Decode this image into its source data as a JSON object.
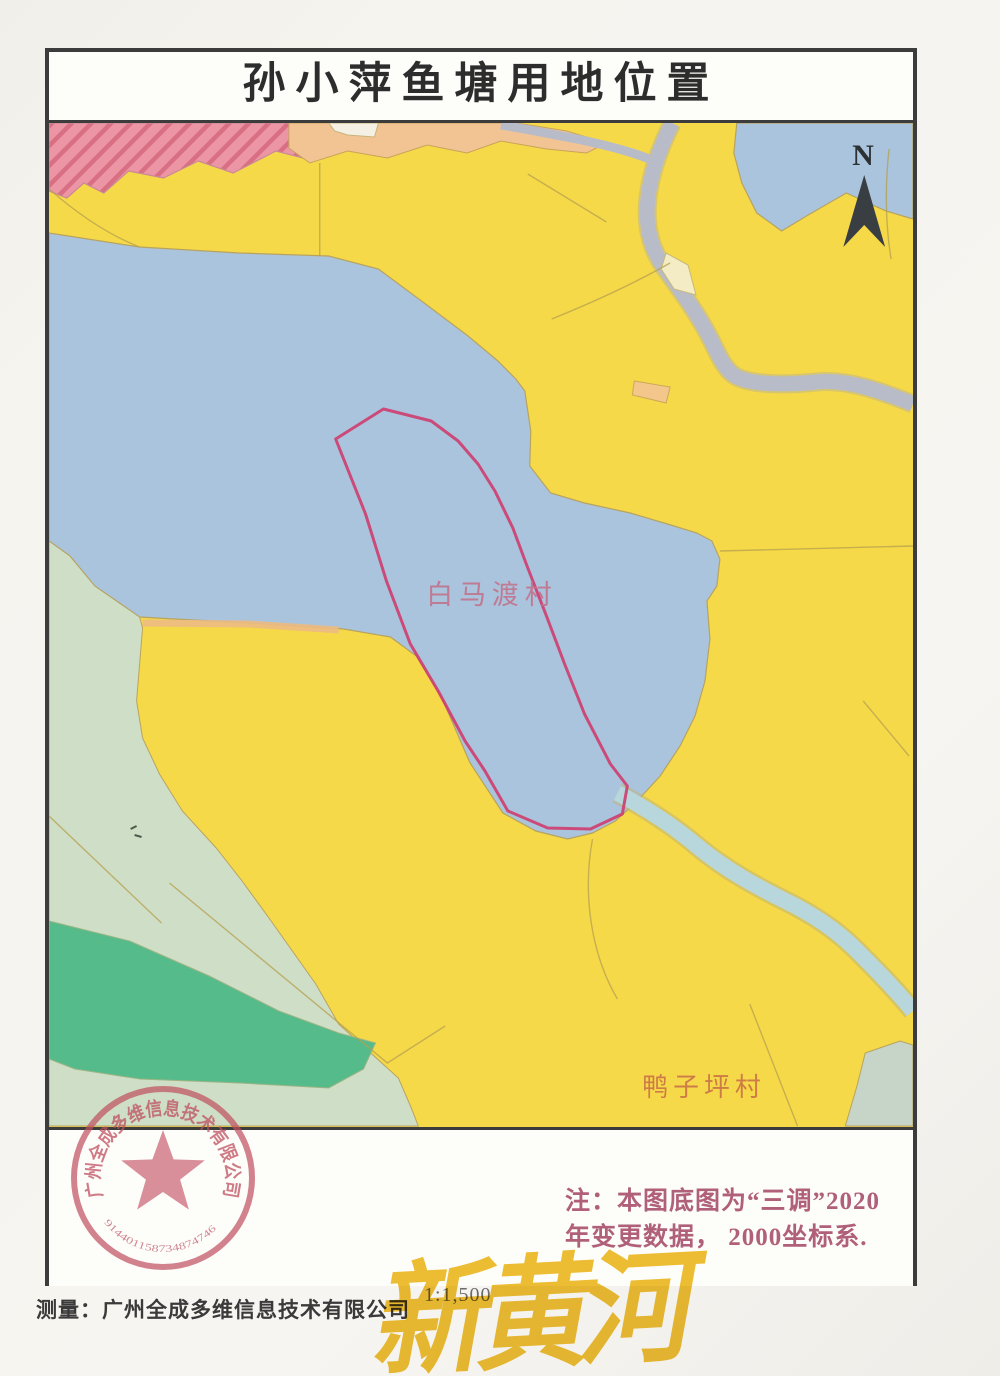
{
  "title": "孙小萍鱼塘用地位置",
  "compass": {
    "label": "N"
  },
  "map": {
    "labels": {
      "village_center": "白马渡村",
      "village_south": "鸭子坪村"
    }
  },
  "note": {
    "line1": "注：本图底图为“三调”2020",
    "line2": "年变更数据， 2000坐标系."
  },
  "footer": {
    "surveyor": "测量：广州全成多维信息技术有限公司",
    "scale": "1:1,500"
  },
  "stamp": {
    "company": "广州全成多维信息技术有限公司",
    "number": "914401158734874746"
  },
  "watermark": "新黄河",
  "colors": {
    "farmland_yellow": "#f6d948",
    "water_blue": "#a9c4dc",
    "stream_blue": "#b7d7dc",
    "pale_green": "#cfdec6",
    "teal_green": "#56bb8b",
    "pink_hatch": "#ec95a4",
    "road_gray": "#b8bcc8",
    "parcel_red": "#ce3d6e",
    "seal_red": "#c14f5f",
    "gold": "#eebb28"
  }
}
